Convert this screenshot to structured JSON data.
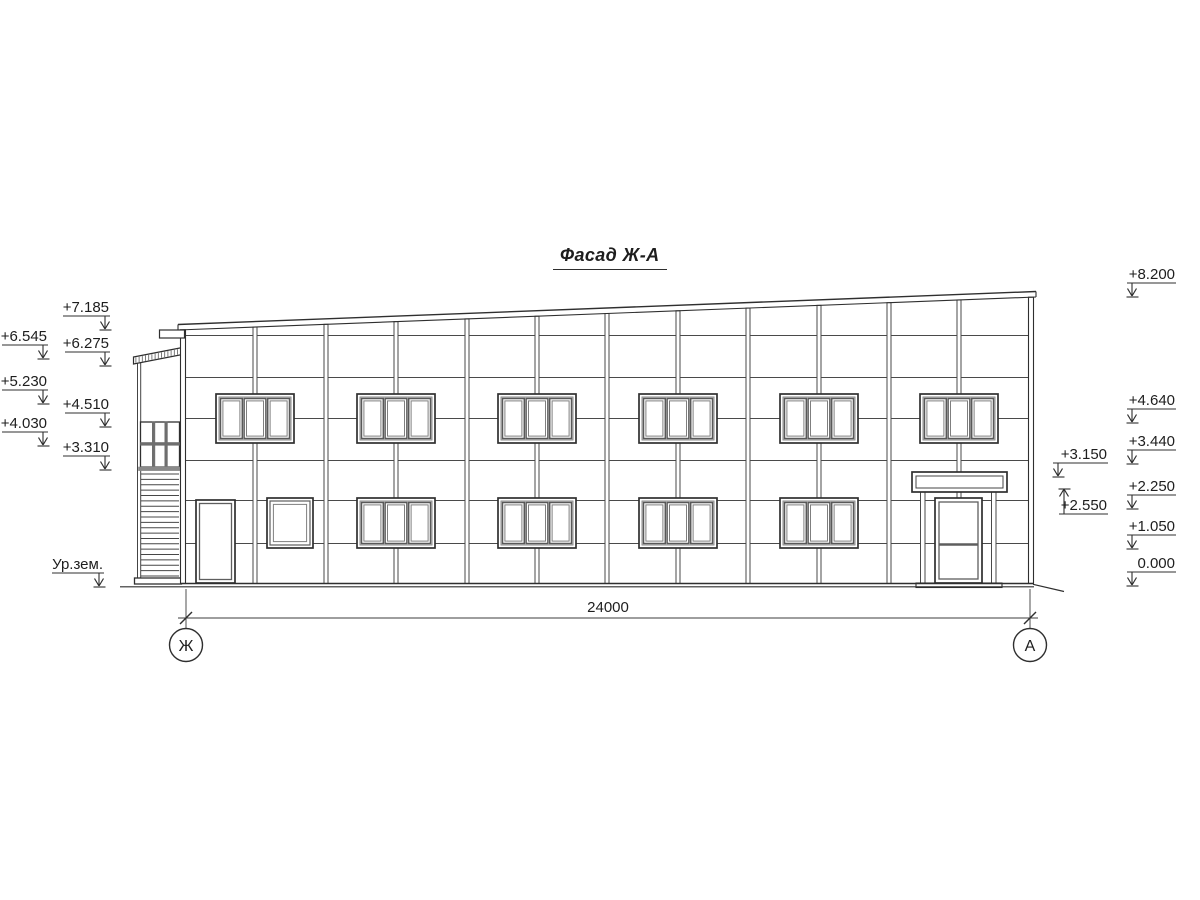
{
  "title": {
    "text": "Фасад Ж-А"
  },
  "dimension": {
    "label": "24000",
    "y": 618,
    "x1": 186,
    "x2": 1030,
    "ext_top": 589,
    "ext_bottom": 629,
    "text_x": 608,
    "text_y": 612
  },
  "axes": [
    {
      "label": "Ж",
      "cx": 186,
      "cy": 645,
      "r": 16.5
    },
    {
      "label": "А",
      "cx": 1030,
      "cy": 645,
      "r": 16.5
    }
  ],
  "elevation_marks": [
    {
      "label": "+7.185",
      "side": "left",
      "dir": "down",
      "line_y": 316,
      "x1": 63,
      "x2": 110
    },
    {
      "label": "+6.545",
      "side": "left",
      "dir": "down",
      "line_y": 345,
      "x1": 2,
      "x2": 48
    },
    {
      "label": "+6.275",
      "side": "left",
      "dir": "down",
      "line_y": 352,
      "x1": 65,
      "x2": 110
    },
    {
      "label": "+5.230",
      "side": "left",
      "dir": "down",
      "line_y": 390,
      "x1": 2,
      "x2": 48
    },
    {
      "label": "+4.510",
      "side": "left",
      "dir": "down",
      "line_y": 413,
      "x1": 65,
      "x2": 110
    },
    {
      "label": "+4.030",
      "side": "left",
      "dir": "down",
      "line_y": 432,
      "x1": 2,
      "x2": 48
    },
    {
      "label": "+3.310",
      "side": "left",
      "dir": "down",
      "line_y": 456,
      "x1": 63,
      "x2": 110
    },
    {
      "label": "Ур.зем.",
      "side": "left",
      "dir": "down",
      "line_y": 573,
      "x1": 52,
      "x2": 104
    },
    {
      "label": "+8.200",
      "side": "right",
      "dir": "down",
      "line_y": 283,
      "x1": 1127,
      "x2": 1176
    },
    {
      "label": "+4.640",
      "side": "right",
      "dir": "down",
      "line_y": 409,
      "x1": 1127,
      "x2": 1176
    },
    {
      "label": "+3.440",
      "side": "right",
      "dir": "down",
      "line_y": 450,
      "x1": 1127,
      "x2": 1176
    },
    {
      "label": "+2.250",
      "side": "right",
      "dir": "down",
      "line_y": 495,
      "x1": 1127,
      "x2": 1176
    },
    {
      "label": "+1.050",
      "side": "right",
      "dir": "down",
      "line_y": 535,
      "x1": 1127,
      "x2": 1176
    },
    {
      "label": "0.000",
      "side": "right",
      "dir": "down",
      "line_y": 572,
      "x1": 1127,
      "x2": 1176
    },
    {
      "label": "+3.150",
      "side": "right",
      "dir": "down",
      "line_y": 463,
      "x1": 1053,
      "x2": 1108
    },
    {
      "label": "+2.550",
      "side": "right",
      "dir": "up",
      "line_y": 514,
      "x1": 1059,
      "x2": 1108,
      "tip_y": 489
    }
  ],
  "drawing": {
    "ink": "#2f2f2f",
    "joint_color": "#4a4a4a",
    "frame_gray": "#6e6e6e",
    "building": {
      "left_wall_x": 181,
      "right_wall_x": 1028.5,
      "wall_w": 5,
      "base_y": 583.5,
      "cap_x1": 178,
      "cap_x2": 1036,
      "cap_top_left_y": 324.5,
      "cap_top_right_y": 291.5,
      "cap_th": 5.5,
      "ledge": {
        "x": 159.5,
        "y": 330,
        "w": 25,
        "h": 8
      }
    },
    "ground": {
      "y": 586.8,
      "x1": 120,
      "x2": 1034,
      "slope_x2": 1064,
      "slope_y2": 591.5
    },
    "joints_y": [
      335,
      377,
      418,
      460,
      500,
      543
    ],
    "mullions_x": [
      255,
      326,
      396,
      467,
      537,
      607,
      678,
      748,
      819,
      889,
      959
    ],
    "upper_windows": {
      "centers": [
        255,
        396,
        537,
        678,
        819,
        959
      ],
      "y": 394,
      "w": 78,
      "h": 49
    },
    "lower_windows": {
      "centers": [
        396,
        537,
        678,
        819
      ],
      "y": 498,
      "w": 78,
      "h": 50
    },
    "small_window": {
      "x": 267,
      "y": 498,
      "w": 46,
      "h": 50
    },
    "left_door": {
      "x": 196,
      "y": 500,
      "w": 39,
      "h": 83
    },
    "entrance": {
      "canopy": {
        "x": 912,
        "y": 472,
        "w": 95,
        "h": 20
      },
      "posts_x": [
        920.5,
        991.5
      ],
      "post_w": 4.5,
      "post_top": 492,
      "post_bottom": 583,
      "door": {
        "x": 935,
        "y": 498,
        "w": 47,
        "h": 85,
        "rail_y": 544.5
      },
      "step": {
        "x": 916,
        "y": 583,
        "w": 86,
        "h": 4.5
      }
    },
    "tower": {
      "roof": {
        "x1": 133.5,
        "x2": 185,
        "top_y1": 357,
        "top_y2": 347,
        "th": 7,
        "hatch_step": 3.2
      },
      "left_wall": {
        "x": 137.5,
        "w": 3.2,
        "top": 363,
        "bottom": 578
      },
      "glazing": {
        "x": 140.5,
        "y": 422,
        "w": 39,
        "h": 45,
        "bar_xs": [
          152.3,
          164.8
        ],
        "bar_w": 2.6,
        "mid_y": 442.5,
        "mid_h": 2.8
      },
      "sill": {
        "x": 138.5,
        "y": 467,
        "w": 43,
        "h": 3.6
      },
      "louvers": {
        "x1": 141,
        "x2": 179,
        "y_start": 474,
        "step": 5.37,
        "count": 20
      },
      "plinth": {
        "x": 134.5,
        "y": 578,
        "w": 47,
        "h": 6
      }
    }
  }
}
